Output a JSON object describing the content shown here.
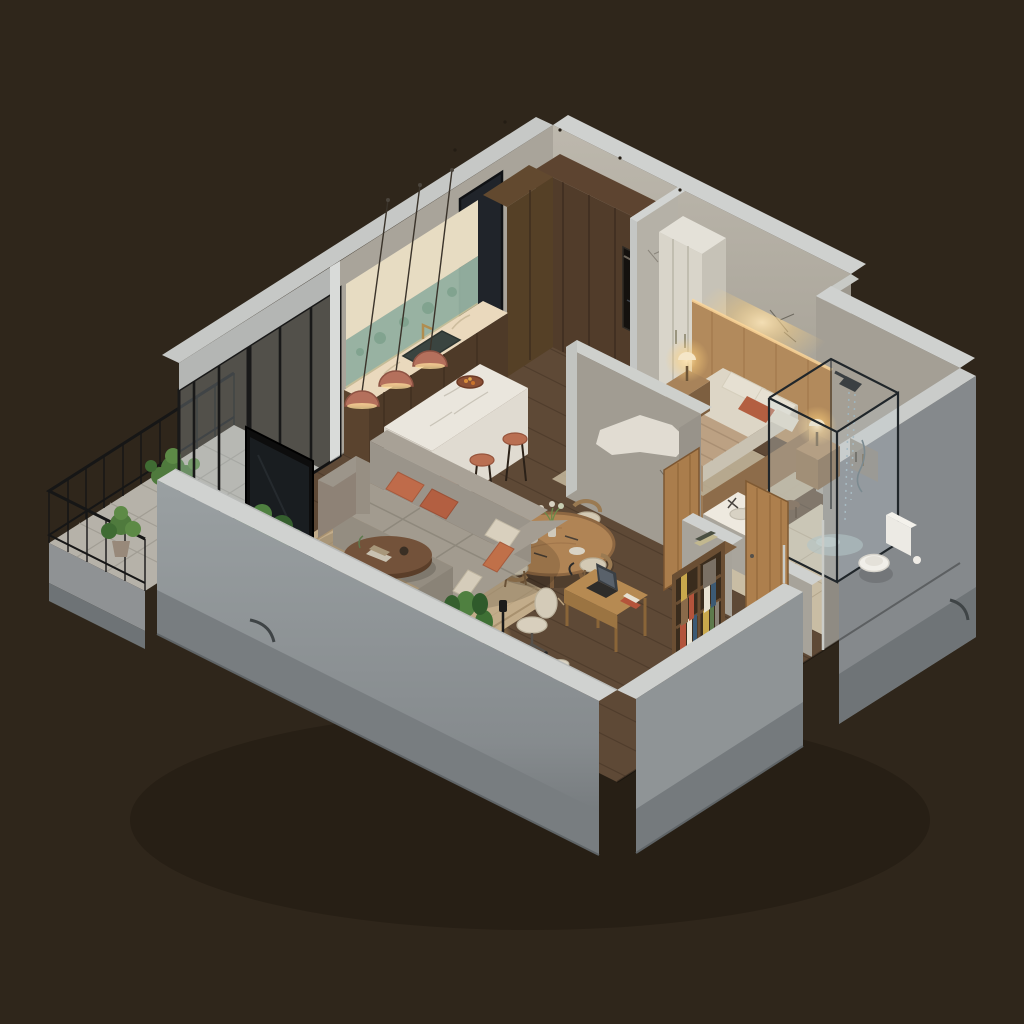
{
  "scene": {
    "type": "isometric-apartment-cutaway-render",
    "style": "photorealistic 3D floor plan, warm lighting, dark brown backdrop",
    "rooms": [
      {
        "name": "kitchen",
        "items": [
          "l-shaped-walnut-cabinets",
          "cream-marble-counter",
          "green-tile-backsplash",
          "brass-faucet-sink",
          "built-in-oven",
          "marble-island",
          "fruit-bowl",
          "terracotta-pendant-light",
          "terracotta-pendant-light",
          "terracotta-pendant-light",
          "bar-stool",
          "bar-stool",
          "bar-stool"
        ]
      },
      {
        "name": "bedroom",
        "items": [
          "double-bed",
          "wood-headboard-with-backlight",
          "terracotta-accent-pillow",
          "nightstand-left",
          "nightstand-right",
          "glowing-table-lamp",
          "glowing-table-lamp",
          "cream-wardrobe",
          "beige-rug",
          "plaster-art-wall"
        ]
      },
      {
        "name": "bathroom",
        "items": [
          "glass-shower-enclosure",
          "rain-shower-head",
          "water-puddle",
          "toilet",
          "marble-vanity-sink",
          "dark-framed-window",
          "toilet-paper-stand",
          "open-wood-door"
        ]
      },
      {
        "name": "living-room",
        "items": [
          "gray-sectional-sofa",
          "terracotta-pillows",
          "cream-pillows",
          "woven-area-rug",
          "oval-coffee-table",
          "walnut-tv-console",
          "flat-tv",
          "speakers",
          "floor-lamp",
          "fiddle-leaf-fig-plant",
          "monstera-plant"
        ]
      },
      {
        "name": "dining-area",
        "items": [
          "round-wood-table",
          "dining-chair",
          "dining-chair",
          "dining-chair",
          "dining-chair",
          "flower-vase"
        ]
      },
      {
        "name": "workspace",
        "items": [
          "wood-desk",
          "laptop",
          "office-chair",
          "bookshelf-with-books",
          "basket",
          "dark-stool"
        ]
      },
      {
        "name": "balcony",
        "items": [
          "black-metal-railing",
          "potted-plant",
          "potted-plant",
          "tile-floor",
          "sliding-glass-doors"
        ]
      },
      {
        "name": "hallway",
        "items": [
          "open-wood-door",
          "wood-floor"
        ]
      }
    ],
    "counts": {
      "pendant_lights": 3,
      "bar_stools": 3,
      "dining_chairs": 4,
      "table_lamps": 2,
      "balcony_plants": 2,
      "wood_doors": 2
    }
  },
  "palette": {
    "bg": "#2f261b",
    "shadow": "#201910",
    "wallTop": "#cfd1cf",
    "wallFace": "#aba69b",
    "wallFaceDark": "#8f8b83",
    "wallOuter": "#969b9d",
    "wallBase": "#787d80",
    "plaster": "#eae6dc",
    "floorWood": "#5e4936",
    "floorPlank": "#4a3829",
    "balconyTile": "#b6b2a9",
    "bathFloor": "#c9bda4",
    "rugLiving": "#c2ac8a",
    "rugBedroom": "#c6b89e",
    "marble": "#eae6dd",
    "counterCream": "#ead9bd",
    "woodDark": "#513c2a",
    "woodMid": "#6b4e34",
    "oak": "#aa7d4c",
    "terracotta": "#b4705c",
    "terracottaDeep": "#a75a3c",
    "sofaGray": "#a29b8f",
    "sofaBack": "#9a948a",
    "cream": "#d9d5ca",
    "bedding": "#ddd6c6",
    "blanket": "#bca183",
    "greenTile": "#97b3a2",
    "plantGreen": "#4f8040",
    "plantGreenDark": "#2f5a2b",
    "glassFrame": "#1d1d1d",
    "tvBlack": "#0d0d0d",
    "glowWarm": "#ffdf9e"
  }
}
